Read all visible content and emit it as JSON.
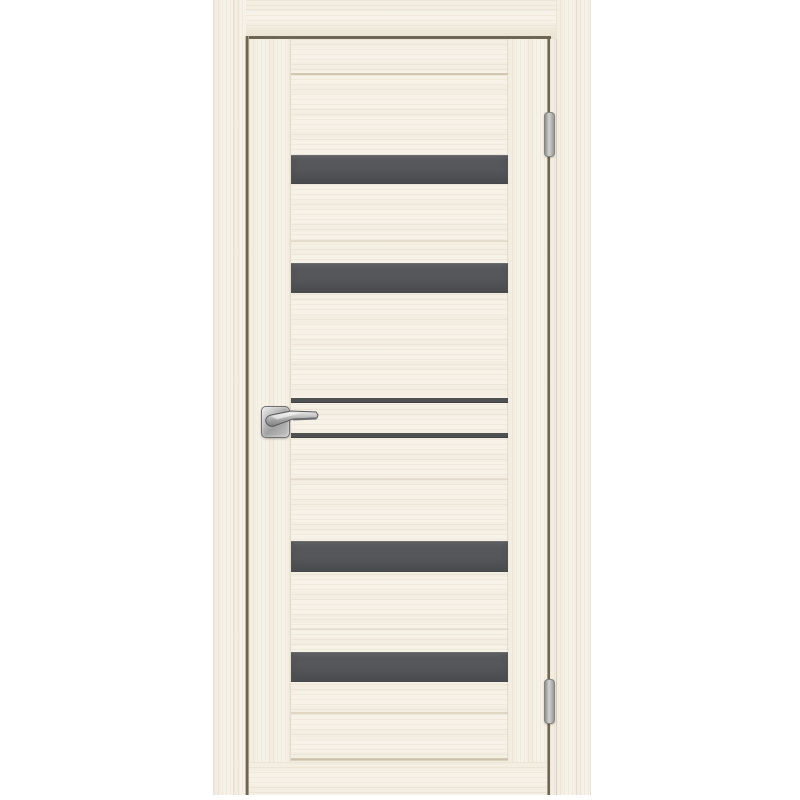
{
  "scene": {
    "type": "product-photo",
    "subject": "Closed interior door in a light cream bleached-oak finish shown inside its frame, with four wide dark-grey horizontal glass inserts, two narrow dark-grey aluminium moldings, a matte-chrome square-rosette lever handle on the left and two barrel hinges on the right",
    "background_color": "#ffffff"
  },
  "door": {
    "finish_name": "bleached oak / cream",
    "glass_inserts": {
      "count": 4,
      "orientation": "horizontal"
    },
    "narrow_moldings": {
      "count": 2
    },
    "hinges": {
      "count": 2,
      "side": "right"
    },
    "handle": {
      "style": "square-rosette lever",
      "finish": "matte chrome",
      "side": "left"
    },
    "colors": {
      "wood": "#f7f2e8",
      "wood_shadow": "#ece5d5",
      "grain": "#dbcfb8",
      "glass": "#56575a",
      "glass_top_edge": "#6b6c6f",
      "molding": "#4e5052",
      "gap_line": "#6f6554",
      "groove": "#d5cab6",
      "metal": "#b9b9b9",
      "metal_dark": "#6f6f6f"
    }
  }
}
